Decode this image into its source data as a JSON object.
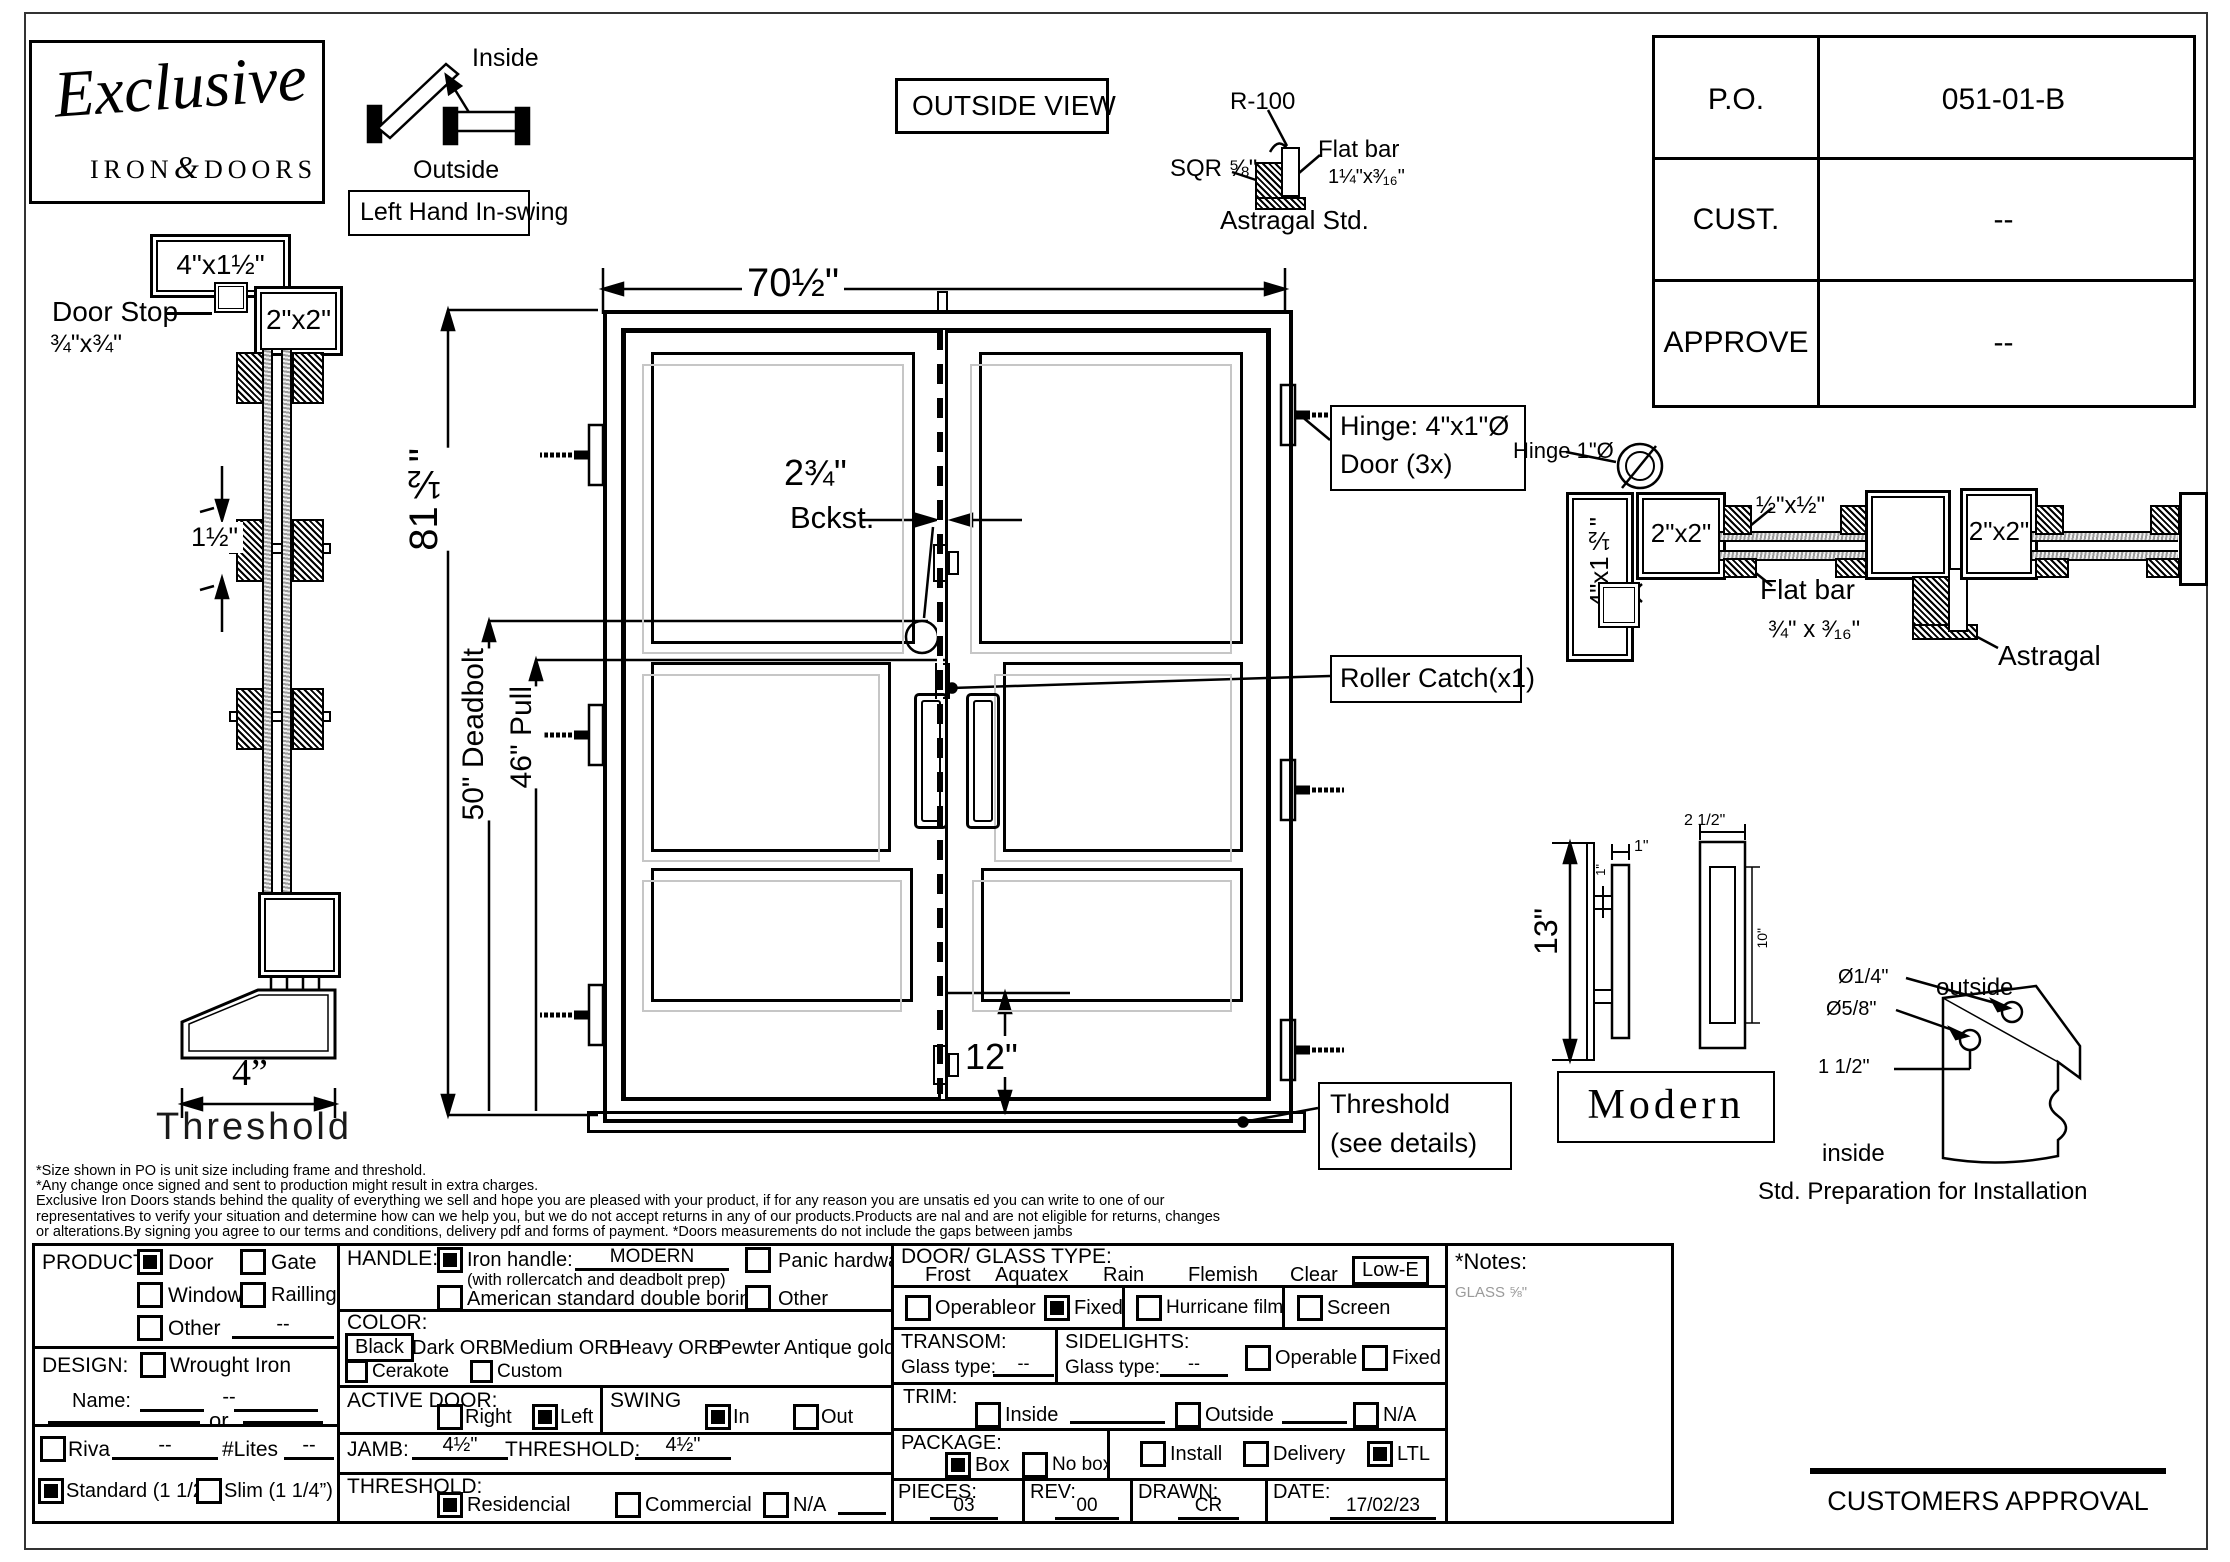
{
  "brand": {
    "script": "Exclusive",
    "iron": "IRON",
    "amp": "&",
    "doors": "DOORS"
  },
  "swing_diagram": {
    "inside": "Inside",
    "outside": "Outside",
    "label": "Left Hand In-swing"
  },
  "view_label": "OUTSIDE VIEW",
  "po_table": {
    "rows": [
      {
        "label": "P.O.",
        "value": "051-01-B"
      },
      {
        "label": "CUST.",
        "value": "--"
      },
      {
        "label": "APPROVE",
        "value": "--"
      }
    ]
  },
  "astragal_detail": {
    "r": "R-100",
    "sqr": "SQR ⅝\"",
    "flat_bar": "Flat bar",
    "flat_bar_size": "1¼\"x³⁄₁₆\"",
    "caption": "Astragal Std."
  },
  "left_section": {
    "frame_label": "4\"x1½\"",
    "tube_label": "2\"x2\"",
    "stop": "Door Stop",
    "stop_size": "¾\"x¾\"",
    "gap": "1½\"",
    "threshold_dim": "4”",
    "threshold": "Threshold"
  },
  "door": {
    "width": "70½\"",
    "height": "81½\"",
    "backset": "2¾\"",
    "backset_label": "Bckst.",
    "deadbolt": "50\" Deadbolt",
    "pull": "46\" Pull",
    "bottom": "12\"",
    "hinge_note1": "Hinge: 4\"x1\"Ø",
    "hinge_note2": "Door (3x)",
    "roller": "Roller Catch(x1)",
    "threshold1": "Threshold",
    "threshold2": "(see details)"
  },
  "plan": {
    "hinge": "Hinge 1\"Ø",
    "jamb": "4\"x1½\"",
    "tube1": "2\"x2\"",
    "half": "½\"x½\"",
    "flat_bar": "Flat bar",
    "flat_size": "¾\" x ³⁄₁₆\"",
    "tube2": "2\"x2\"",
    "astragal": "Astragal"
  },
  "handle_detail": {
    "h": "13\"",
    "one_top": "1\"",
    "one_side": "1\"",
    "plate": "2 1/2\"",
    "slot": "10\"",
    "name": "Modern"
  },
  "install": {
    "d1": "Ø1/4\"",
    "d2": "Ø5/8\"",
    "off": "1 1/2\"",
    "outside": "outside",
    "inside": "inside",
    "caption": "Std. Preparation for Installation"
  },
  "disclaimer": {
    "l1": "*Size shown in PO is unit size including frame and threshold.",
    "l2": "*Any change once signed and sent to production might result in extra charges.",
    "l3": "Exclusive Iron Doors stands behind the quality of everything we sell and hope you are pleased with your product, if for any reason you are unsatis ed you can write to one of our",
    "l4": "representatives to verify your situation and determine how can we help you, but we do not accept returns in any of our products.Products are  nal and are not eligible for returns, changes",
    "l5": "or alterations.By signing you agree to our terms and conditions, delivery pdf and forms of payment. *Doors measurements do not include the gaps between jambs"
  },
  "form": {
    "product": {
      "label": "PRODUCT:",
      "door": "Door",
      "door_checked": true,
      "gate": "Gate",
      "gate_checked": false,
      "window": "Window",
      "window_checked": false,
      "railing": "Railling",
      "railing_checked": false,
      "other": "Other",
      "other_checked": false,
      "other_value": "--"
    },
    "design": {
      "label": "DESIGN:",
      "wrought": "Wrought Iron",
      "wrought_checked": false,
      "name_label": "Name:",
      "name_value": "--",
      "or_label": "or"
    },
    "riva": {
      "label": "Riva",
      "checked": false,
      "value": "--",
      "lites": "#Lites",
      "lites_value": "--"
    },
    "profile": {
      "standard": "Standard (1 1/2”)",
      "standard_checked": true,
      "slim": "Slim (1 1/4”)",
      "slim_checked": false
    },
    "handle": {
      "label": "HANDLE:",
      "iron": "Iron handle:",
      "iron_checked": true,
      "iron_value": "MODERN",
      "note": "(with rollercatch and deadbolt prep)",
      "american": "American standard double boring",
      "american_checked": false,
      "panic": "Panic hardware",
      "panic_checked": false,
      "other": "Other",
      "other_checked": false
    },
    "color": {
      "label": "COLOR:",
      "selected": "Black",
      "opt1": "Dark ORB",
      "opt2": "Medium ORB",
      "opt3": "Heavy ORB",
      "opt4": "Pewter",
      "opt5": "Antique gold",
      "cerakote": "Cerakote",
      "cerakote_checked": false,
      "custom": "Custom",
      "custom_checked": false
    },
    "active": {
      "label": "ACTIVE DOOR:",
      "right": "Right",
      "right_checked": false,
      "left": "Left",
      "left_checked": true
    },
    "swing": {
      "label": "SWING",
      "in": "In",
      "in_checked": true,
      "out": "Out",
      "out_checked": false
    },
    "jamb": {
      "label": "JAMB:",
      "value": "4½\"",
      "t_label": "THRESHOLD:",
      "t_value": "4½\""
    },
    "threshold": {
      "label": "THRESHOLD:",
      "res": "Residencial",
      "res_checked": true,
      "com": "Commercial",
      "com_checked": false,
      "na": "N/A",
      "na_checked": false
    },
    "glass": {
      "label": "DOOR/ GLASS TYPE:",
      "o1": "Frost",
      "o2": "Aquatex",
      "o3": "Rain",
      "o4": "Flemish",
      "o5": "Clear",
      "sel": "Low-E"
    },
    "fixed_row": {
      "operable": "Operable",
      "operable_checked": false,
      "or_label": "or",
      "fixed": "Fixed",
      "fixed_checked": true,
      "hurricane": "Hurricane film",
      "hurricane_checked": false,
      "screen": "Screen",
      "screen_checked": false
    },
    "transom": {
      "label": "TRANSOM:",
      "glass": "Glass type:",
      "value": "--"
    },
    "sidelights": {
      "label": "SIDELIGHTS:",
      "glass": "Glass type:",
      "value": "--",
      "operable": "Operable",
      "operable_checked": false,
      "fixed": "Fixed",
      "fixed_checked": false
    },
    "trim": {
      "label": "TRIM:",
      "inside": "Inside",
      "inside_checked": false,
      "outside": "Outside",
      "outside_checked": false,
      "na": "N/A",
      "na_checked": false
    },
    "package": {
      "label": "PACKAGE:",
      "box": "Box",
      "box_checked": true,
      "nobox": "No box",
      "nobox_checked": false,
      "install": "Install",
      "install_checked": false,
      "delivery": "Delivery",
      "delivery_checked": false,
      "ltl": "LTL",
      "ltl_checked": true
    },
    "pieces": {
      "label": "PIECES:",
      "value": "03"
    },
    "rev": {
      "label": "REV:",
      "value": "00"
    },
    "drawn": {
      "label": "DRAWN:",
      "value": "CR"
    },
    "date": {
      "label": "DATE:",
      "value": "17/02/23"
    },
    "notes": {
      "label": "*Notes:",
      "value": "GLASS ⅝\""
    }
  },
  "approval": "CUSTOMERS APPROVAL"
}
